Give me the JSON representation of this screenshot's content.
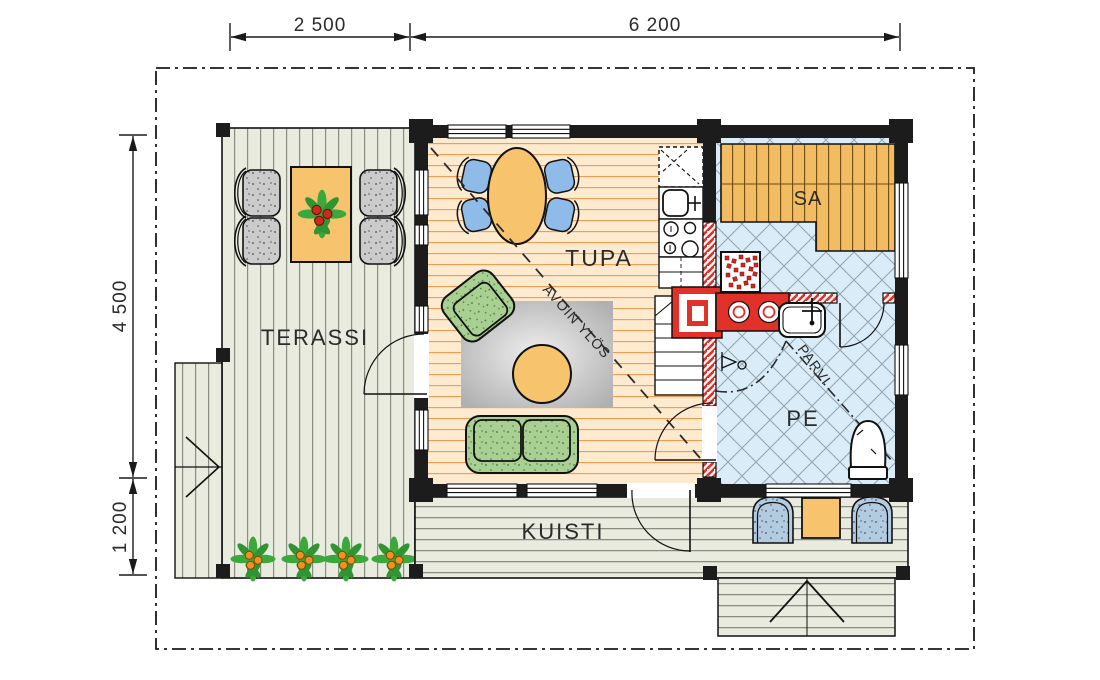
{
  "palette": {
    "wall": "#1c1c1c",
    "red_masonry": "#e23128",
    "tupa_floor": "#fdeacf",
    "deck_floor": "#e9ebdf",
    "tile_floor": "#daecf7",
    "sauna_bench": "#f2bc62",
    "furniture_orange": "#f7c46d",
    "chair_blue": "#8fbbe8",
    "upholstery_green": "#a9cf92",
    "terrace_chair_gray": "#cbcbcb",
    "porch_chair_blue": "#b3cbdf",
    "plant_green": "#3aa83a",
    "berry_orange": "#f09020",
    "berry_red": "#cc2a1e"
  },
  "dims": {
    "top": [
      "2 500",
      "6 200"
    ],
    "left": [
      "4 500",
      "1 200"
    ]
  },
  "rooms": {
    "terassi": {
      "label": "TERASSI"
    },
    "tupa": {
      "label": "TUPA"
    },
    "kuisti": {
      "label": "KUISTI"
    },
    "sauna": {
      "label": "SA"
    },
    "washroom": {
      "label": "PE"
    }
  },
  "annotations": {
    "open_above": {
      "label": "AVOIN YLÖS"
    },
    "loft": {
      "label": "PARVI"
    }
  }
}
